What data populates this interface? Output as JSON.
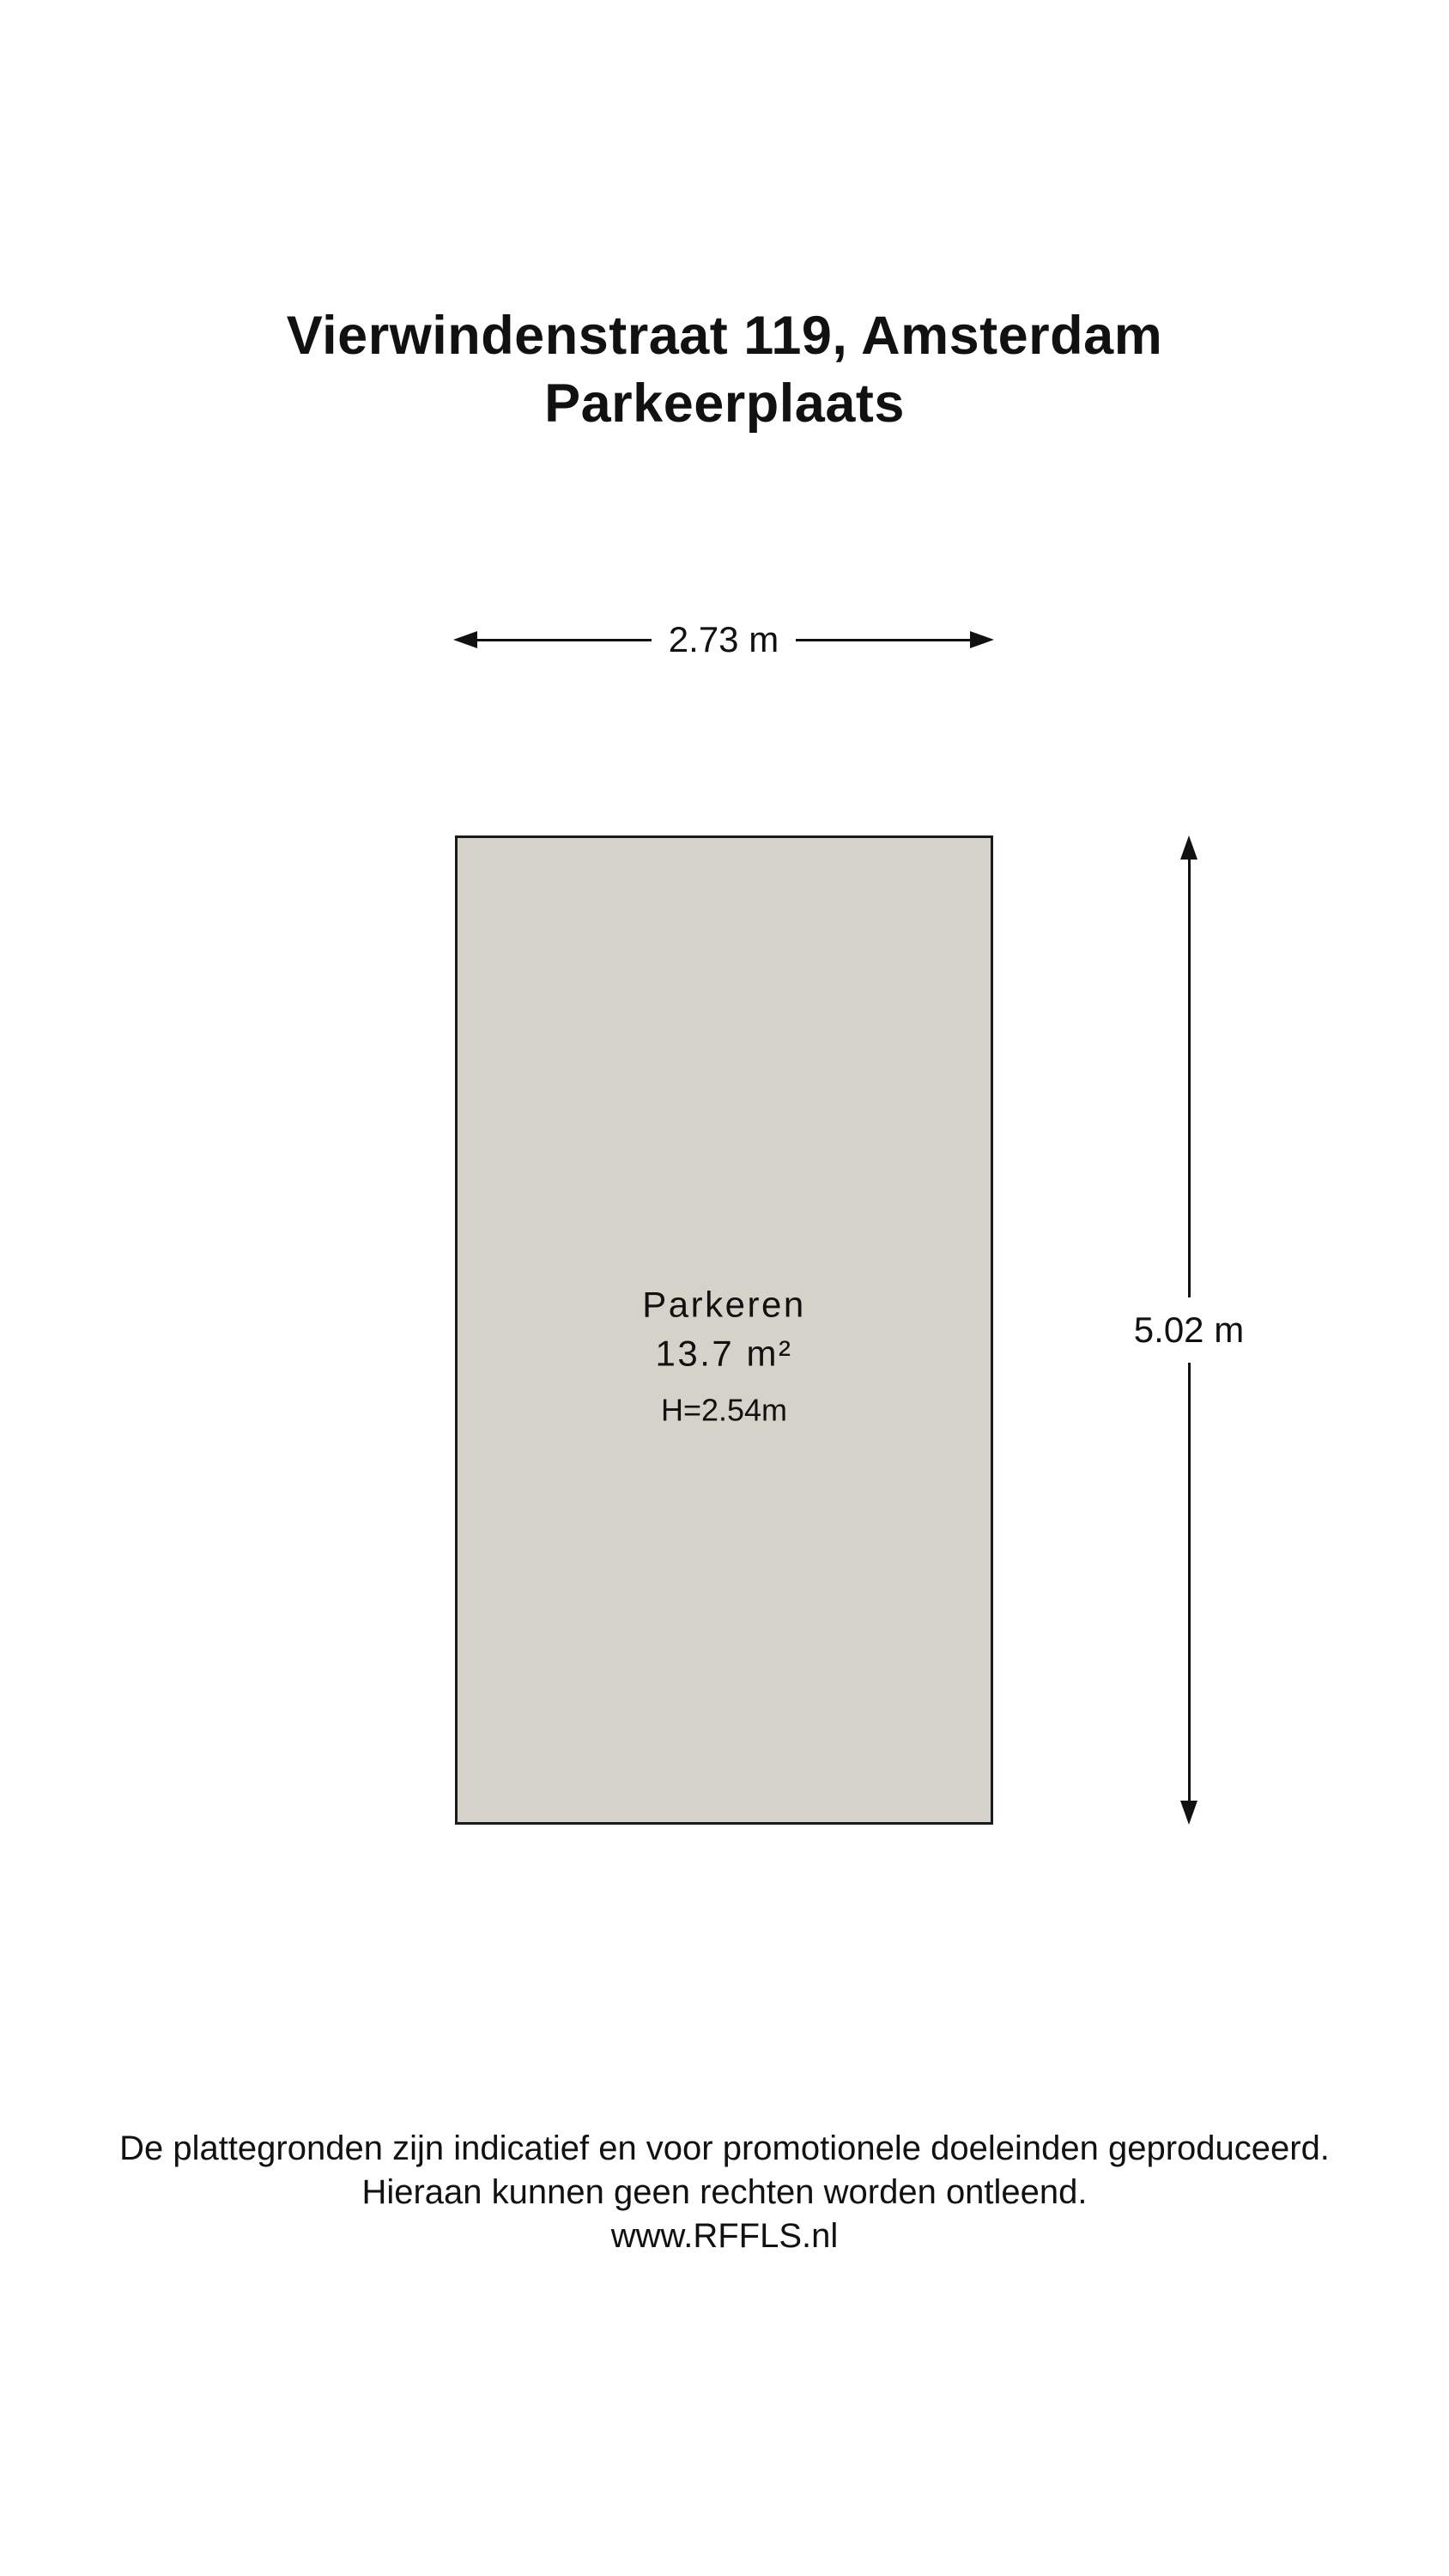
{
  "page": {
    "title_line1": "Vierwindenstraat 119, Amsterdam",
    "title_line2": "Parkeerplaats"
  },
  "floorplan": {
    "room": {
      "name": "Parkeren",
      "area": "13.7 m²",
      "ceiling_height": "H=2.54m",
      "fill_color": "#d5d2ca",
      "border_color": "#1a1a1a"
    },
    "dimensions": {
      "width_label": "2.73 m",
      "height_label": "5.02 m"
    }
  },
  "footer": {
    "line1": "De plattegronden zijn indicatief en voor promotionele doeleinden geproduceerd.",
    "line2": "Hieraan kunnen geen rechten worden ontleend.",
    "line3": "www.RFFLS.nl"
  }
}
